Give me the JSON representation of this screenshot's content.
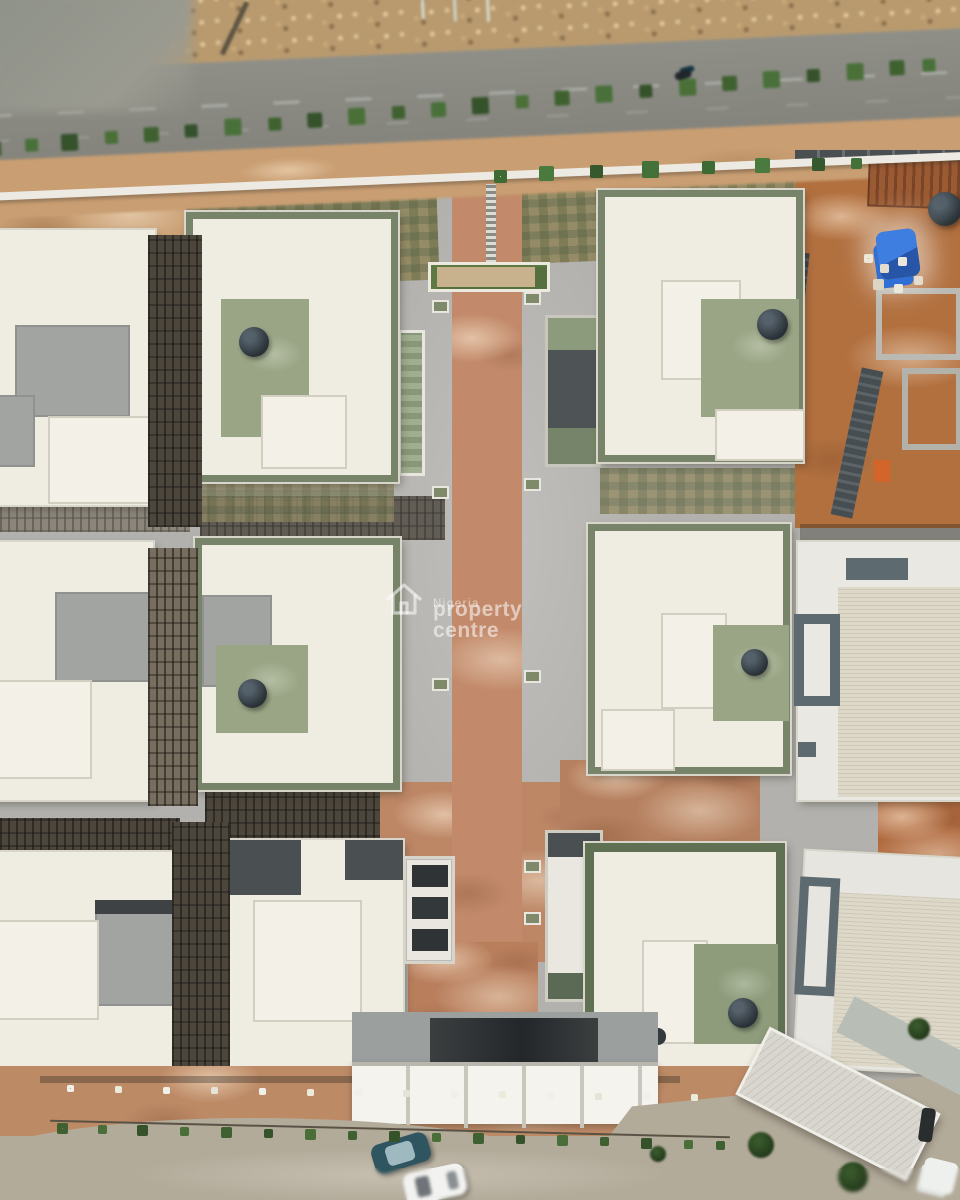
{
  "scene": {
    "type": "aerial-drone-photo",
    "description": "Top-down aerial view of a gated residential estate under construction beside a highway, Nigeria",
    "palette": {
      "asphalt": "#8c8c85",
      "estate_concrete": "#b2b1ad",
      "central_path_dirt": "#c28a6a",
      "construction_dirt": "#b06a3f",
      "roof_cream": "#efece1",
      "roof_green": "#9aa586",
      "roof_green_border": "#77846a",
      "water_tank": "#2a3237",
      "vegetation": "#3f6130",
      "perimeter_wall": "#eceae2",
      "access_road": "#b3ab9a",
      "car_teal": "#2e5560",
      "car_white": "#f2f2f0",
      "mixer_blue": "#2f6fd6",
      "container_rust": "#9a5a33"
    },
    "objects": [
      "highway",
      "motorcycle",
      "street-pole-shadow",
      "tree-row",
      "perimeter-wall",
      "grass-paver-strip",
      "central-walkway",
      "planter-box",
      "villa-under-construction",
      "green-flat-roof",
      "water-tank",
      "scaffolding",
      "construction-yard",
      "shipping-container",
      "concrete-mixer",
      "foundation-outline",
      "cement-sacks",
      "carport-row",
      "entrance-court",
      "hedge-row",
      "access-road",
      "car-teal",
      "car-white",
      "roadside-trees"
    ]
  },
  "watermark": {
    "icon": "house-outline-icon",
    "brand_top": "Nigeria",
    "brand_bottom": "property centre",
    "color": "#ffffff",
    "opacity": 0.55
  }
}
